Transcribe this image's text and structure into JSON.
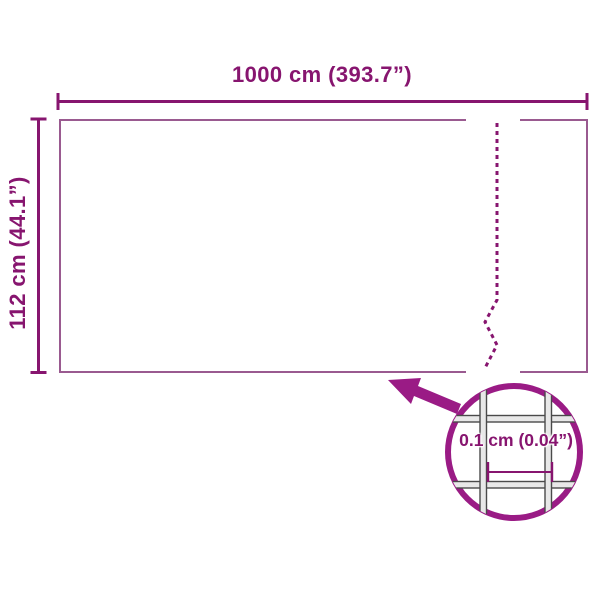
{
  "diagram": {
    "width_label": "1000 cm (393.7”)",
    "height_label": "112 cm (44.1”)",
    "mesh_label": "0.1 cm (0.04”)",
    "colors": {
      "dimension": "#87156f",
      "accent": "#9a1b85",
      "panel-border": "#9a5a90",
      "wire-edge": "#4a4a4a",
      "wire-fill": "#e8e8e8",
      "background": "#ffffff"
    }
  }
}
